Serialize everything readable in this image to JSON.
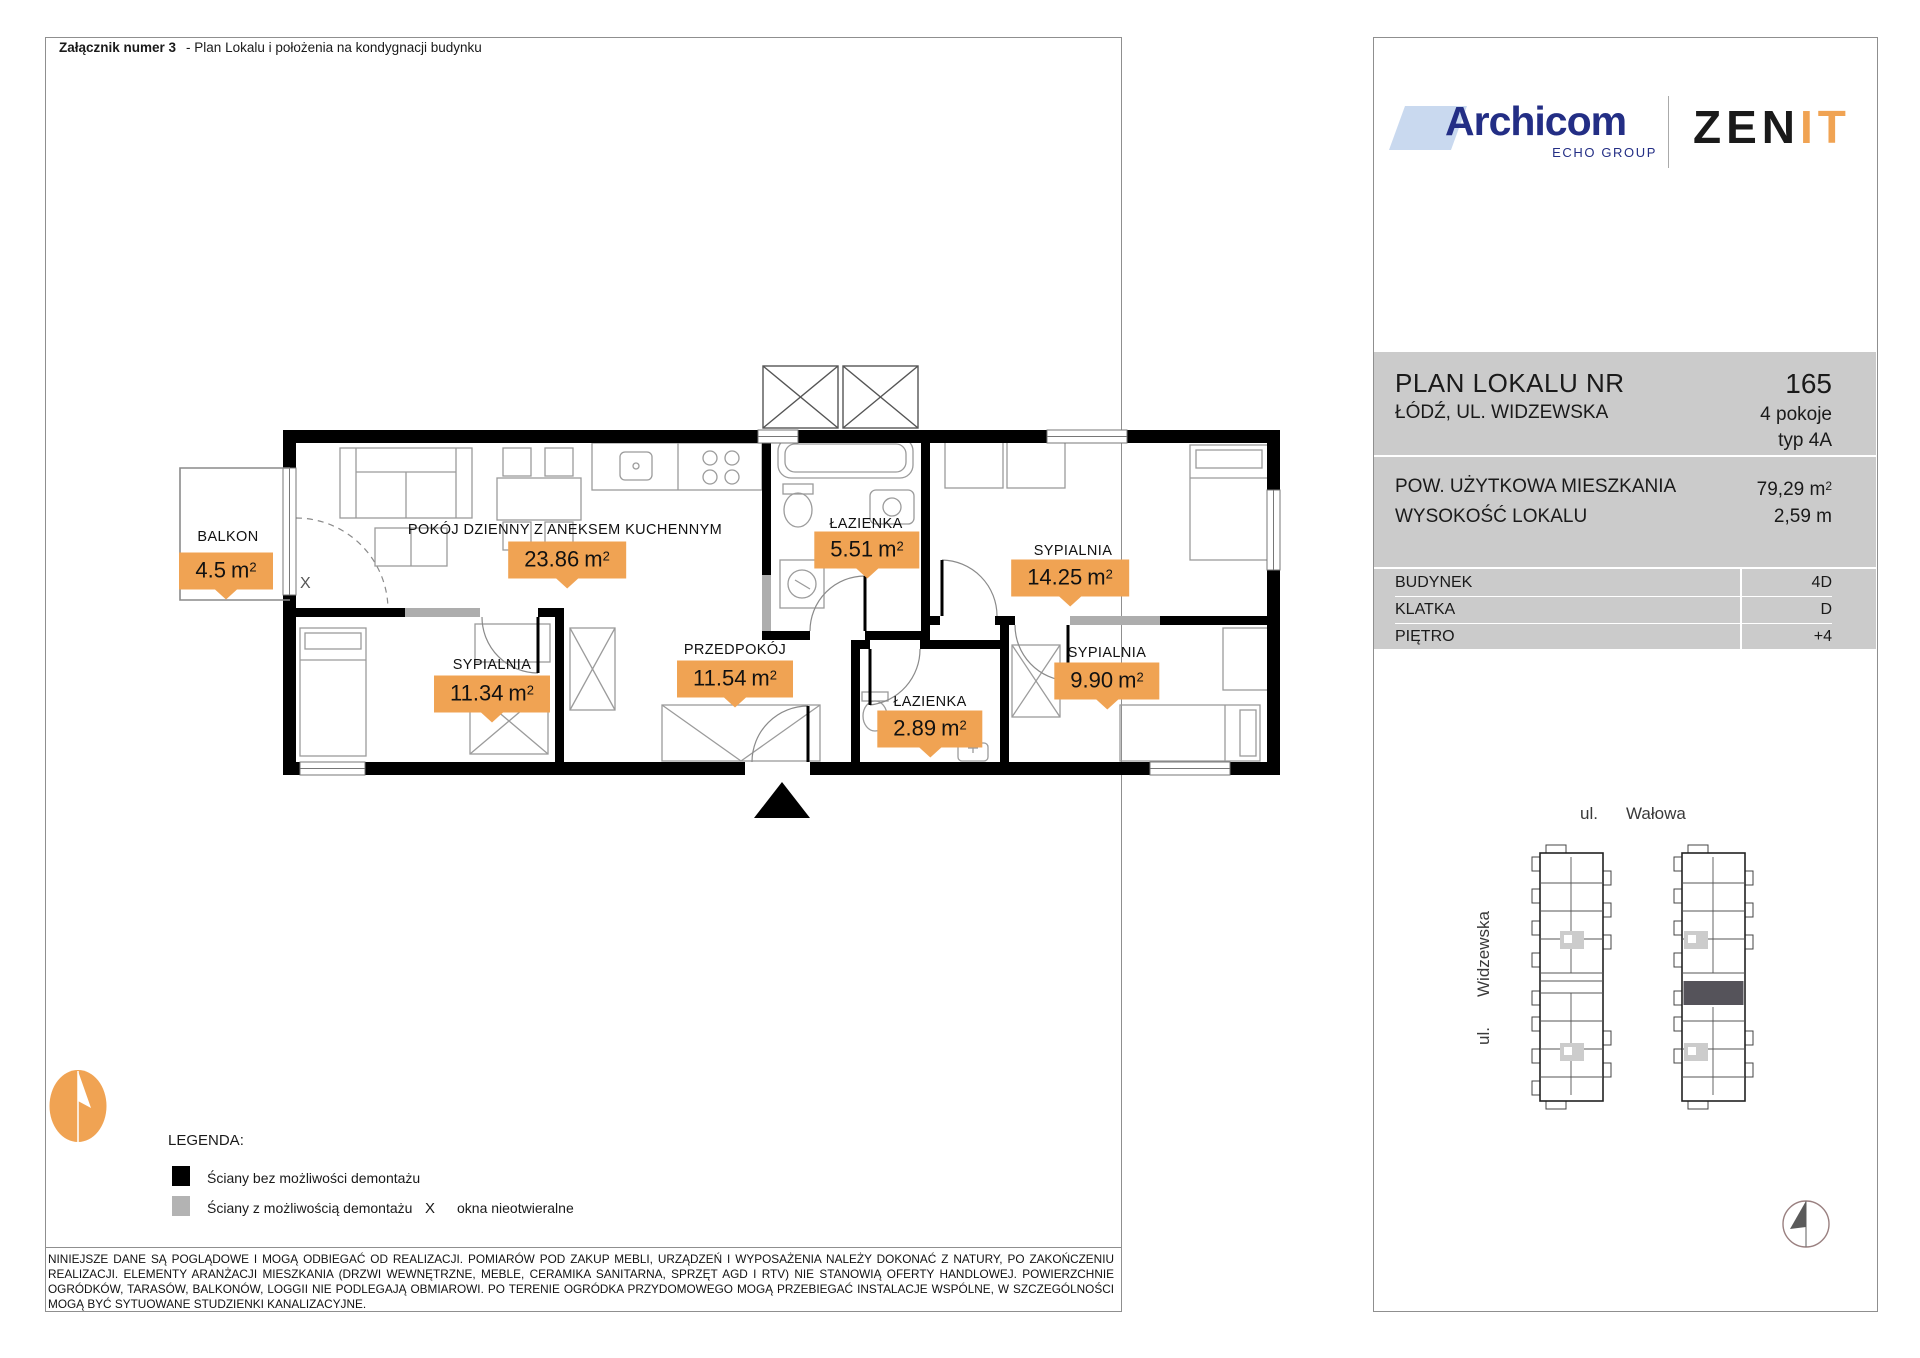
{
  "header": {
    "attachment_label": "Załącznik numer 3",
    "attachment_desc": "- Plan Lokalu i położenia na kondygnacji budynku"
  },
  "branding": {
    "archicom": "Archicom",
    "archicom_sub": "ECHO GROUP",
    "zenit_black": "ZEN",
    "zenit_orange": "IT"
  },
  "info": {
    "title": "PLAN LOKALU NR",
    "number": "165",
    "address": "ŁÓDŹ, UL. WIDZEWSKA",
    "rooms_count": "4 pokoje",
    "type": "typ 4A",
    "area_label": "POW. UŻYTKOWA MIESZKANIA",
    "area_value": "79,29",
    "area_unit": "m",
    "area_sup": "2",
    "height_label": "WYSOKOŚĆ LOKALU",
    "height_value": "2,59 m",
    "rows": [
      {
        "label": "BUDYNEK",
        "value": "4D"
      },
      {
        "label": "KLATKA",
        "value": "D"
      },
      {
        "label": "PIĘTRO",
        "value": "+4"
      }
    ]
  },
  "plan": {
    "unit": "m",
    "unit_sup": "2",
    "window_marker": "X",
    "rooms": [
      {
        "name": "BALKON",
        "area": "4.5"
      },
      {
        "name": "POKÓJ DZIENNY Z ANEKSEM KUCHENNYM",
        "area": "23.86"
      },
      {
        "name": "ŁAZIENKA",
        "area": "5.51"
      },
      {
        "name": "SYPIALNIA",
        "area": "14.25"
      },
      {
        "name": "SYPIALNIA",
        "area": "11.34"
      },
      {
        "name": "PRZEDPOKÓJ",
        "area": "11.54"
      },
      {
        "name": "ŁAZIENKA",
        "area": "2.89"
      },
      {
        "name": "SYPIALNIA",
        "area": "9.90"
      }
    ]
  },
  "legend": {
    "title": "LEGENDA:",
    "solid_label": "Ściany bez możliwości demontażu",
    "demount_label": "Ściany z możliwością demontażu",
    "window_symbol": "X",
    "window_label": "okna nieotwieralne"
  },
  "map": {
    "street_top_prefix": "ul.",
    "street_top_name": "Wałowa",
    "street_left_prefix": "ul.",
    "street_left_name": "Widzewska"
  },
  "disclaimer": "NINIEJSZE DANE SĄ POGLĄDOWE I MOGĄ ODBIEGAĆ OD REALIZACJI. POMIARÓW POD ZAKUP MEBLI, URZĄDZEŃ I WYPOSAŻENIA NALEŻY DOKONAĆ Z NATURY, PO ZAKOŃCZENIU REALIZACJI. ELEMENTY ARANŻACJI MIESZKANIA (DRZWI WEWNĘTRZNE, MEBLE, CERAMIKA SANITARNA, SPRZĘT AGD I RTV) NIE STANOWIĄ OFERTY HANDLOWEJ. POWIERZCHNIE OGRÓDKÓW, TARASÓW, BALKONÓW, LOGGII NIE PODLEGAJĄ OBMIAROWI. PO TERENIE OGRÓDKA PRZYDOMOWEGO MOGĄ PRZEBIEGAĆ INSTALACJE WSPÓLNE, W SZCZEGÓLNOŚCI MOGĄ BYĆ SYTUOWANE STUDZIENKI KANALIZACYJNE."
}
